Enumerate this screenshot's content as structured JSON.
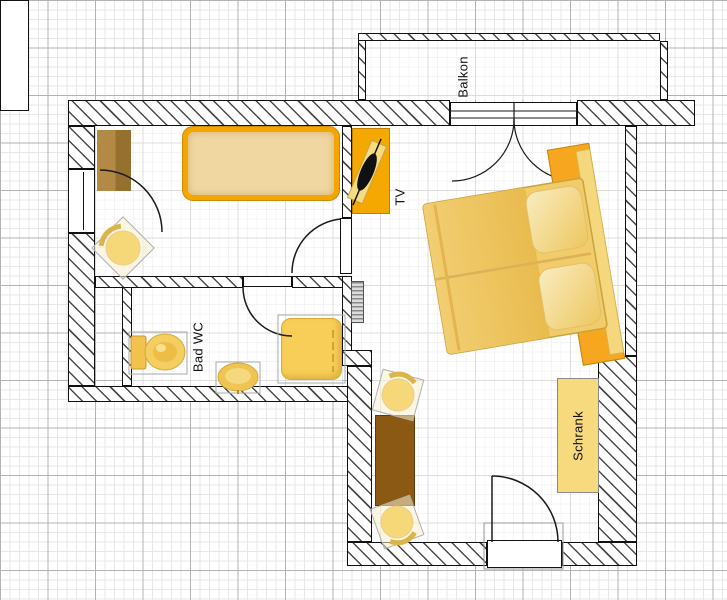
{
  "labels": {
    "balcony": "Balkon",
    "tv": "TV",
    "bath": "Bad WC",
    "wardrobe": "Schrank"
  },
  "colors": {
    "accent_orange": "#F5A800",
    "furniture_amber": "#F5CE62",
    "mattress_tan": "#F0D7A2",
    "pillow_pale": "#FAECC0",
    "table_brown": "#8B5913",
    "desk_brown": "#A8813D",
    "wardrobe_fill": "#F7D97E",
    "wall_outline": "#111111",
    "grid_major": "#b3b3b3",
    "grid_minor": "#e7e7e7"
  },
  "furniture_icons": [
    "single-bed",
    "double-bed",
    "nightstand",
    "desk",
    "chair",
    "tv-set",
    "radiator",
    "toilet",
    "sink",
    "shower-tray",
    "dining-table",
    "wardrobe"
  ]
}
